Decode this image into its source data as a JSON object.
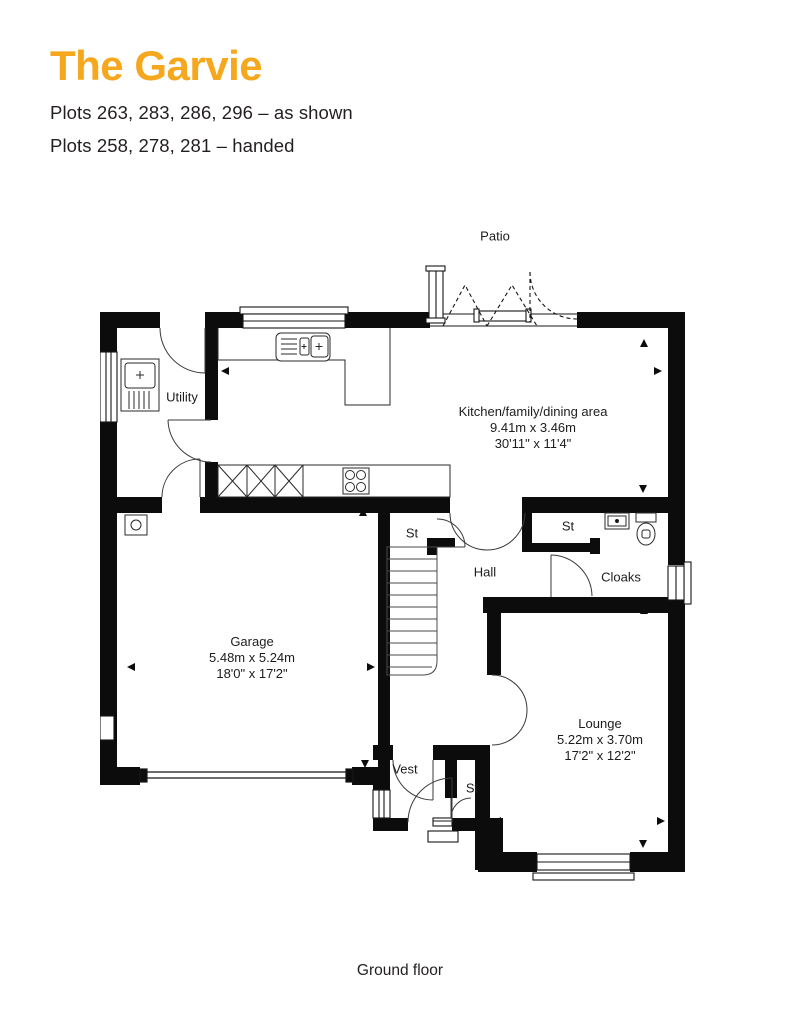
{
  "header": {
    "title": "The Garvie",
    "plots_as_shown": "Plots 263, 283, 286, 296 – as shown",
    "plots_handed": "Plots 258, 278, 281 – handed"
  },
  "floorplan": {
    "floor_label": "Ground floor",
    "outdoor_label": "Patio",
    "rooms": [
      {
        "id": "kitchen",
        "name": "Kitchen/family/dining area",
        "dim_metric": "9.41m x 3.46m",
        "dim_imperial": "30'11\" x 11'4\""
      },
      {
        "id": "utility",
        "name": "Utility"
      },
      {
        "id": "garage",
        "name": "Garage",
        "dim_metric": "5.48m x 5.24m",
        "dim_imperial": "18'0\" x 17'2\""
      },
      {
        "id": "lounge",
        "name": "Lounge",
        "dim_metric": "5.22m x 3.70m",
        "dim_imperial": "17'2\" x 12'2\""
      },
      {
        "id": "hall",
        "name": "Hall"
      },
      {
        "id": "cloaks",
        "name": "Cloaks"
      },
      {
        "id": "vest",
        "name": "Vest"
      },
      {
        "id": "st_upper_left",
        "name": "St"
      },
      {
        "id": "st_upper_right",
        "name": "St"
      },
      {
        "id": "st_lower",
        "name": "St"
      }
    ]
  },
  "colors": {
    "accent": "#f5a71e",
    "text": "#231f20",
    "plan_ink": "#0c0c0c"
  }
}
